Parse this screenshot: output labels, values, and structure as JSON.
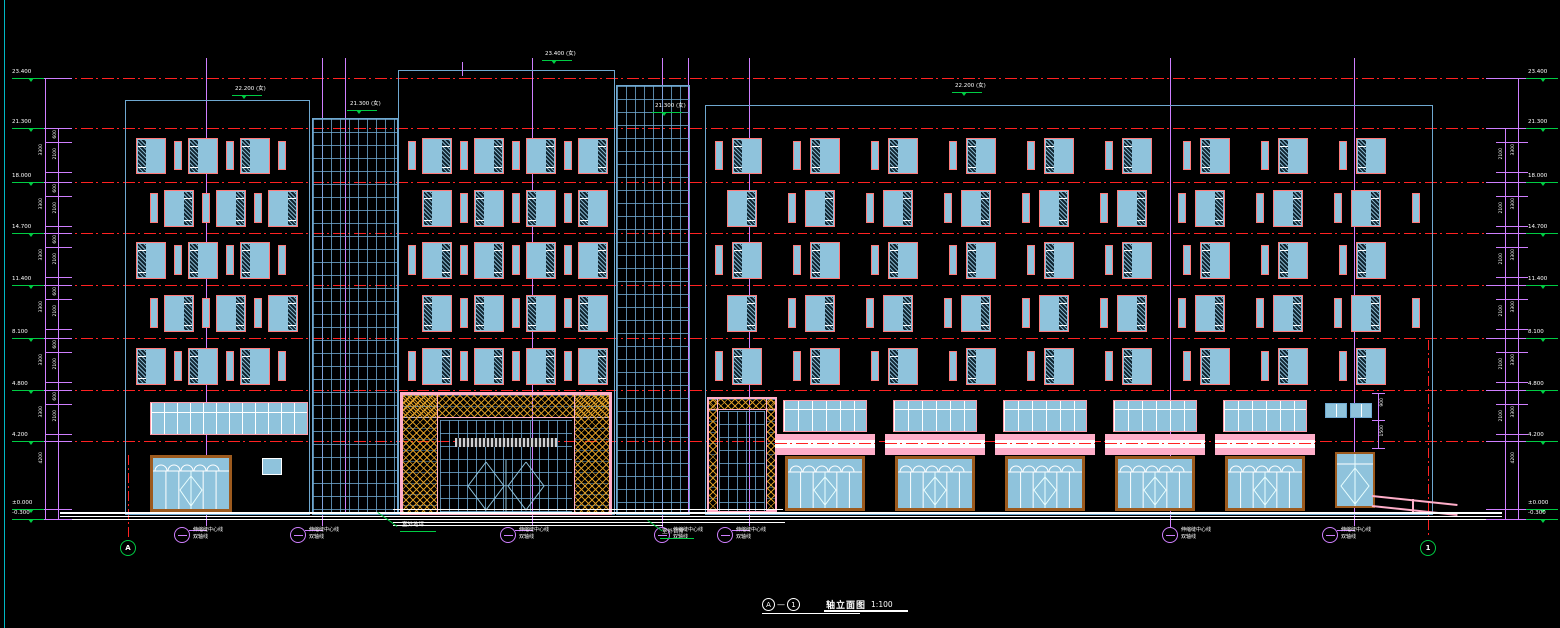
{
  "drawing": {
    "title": {
      "axis_start": "A",
      "separator": "—",
      "axis_end": "1",
      "name": "轴立面图",
      "scale": "1:100"
    },
    "bottom_axis_bubbles": {
      "left_label": "A",
      "right_label": "1"
    },
    "axis_annotation": {
      "line1": "伸缩缝中心线",
      "line2": "双轴线"
    },
    "ground_notes": [
      {
        "text": "室外地坪"
      },
      {
        "text": "室外台阶"
      }
    ],
    "elevation_markers_left": [
      "23.400",
      "21.300",
      "18.000",
      "14.700",
      "11.400",
      "8.100",
      "4.800",
      "4.200",
      "±0.000",
      "-0.300"
    ],
    "elevation_markers_right": [
      "23.400",
      "21.300",
      "18.000",
      "14.700",
      "11.400",
      "8.100",
      "4.800",
      "4.200",
      "±0.000",
      "-0.300"
    ],
    "parapet_tags": [
      {
        "text": "22.200 (女)"
      },
      {
        "text": "21.300 (女)"
      },
      {
        "text": "23.400 (女)"
      },
      {
        "text": "21.300 (女)"
      },
      {
        "text": "22.200 (女)"
      }
    ],
    "dimension_labels": {
      "floor": "3300",
      "ground": "4200",
      "sub_top": "600",
      "sub_mid": "2100",
      "right_small": [
        "900",
        "1500"
      ]
    },
    "colors": {
      "background": "#000000",
      "floor_line_red": "#ff2222",
      "window_fill": "#8fc3dc",
      "window_frame": "#ff7a7a",
      "band_frame": "#ff9aa8",
      "building_outline": "#6fa8d0",
      "grid_magenta": "#cf7fff",
      "marker_green": "#00cc44",
      "truss_orange": "#de9e26",
      "canopy_pink": "#ffaec9",
      "storefront_brown": "#9c5a1e",
      "frame_edge_cyan": "#00b7c3",
      "text_white": "#ffffff"
    }
  }
}
